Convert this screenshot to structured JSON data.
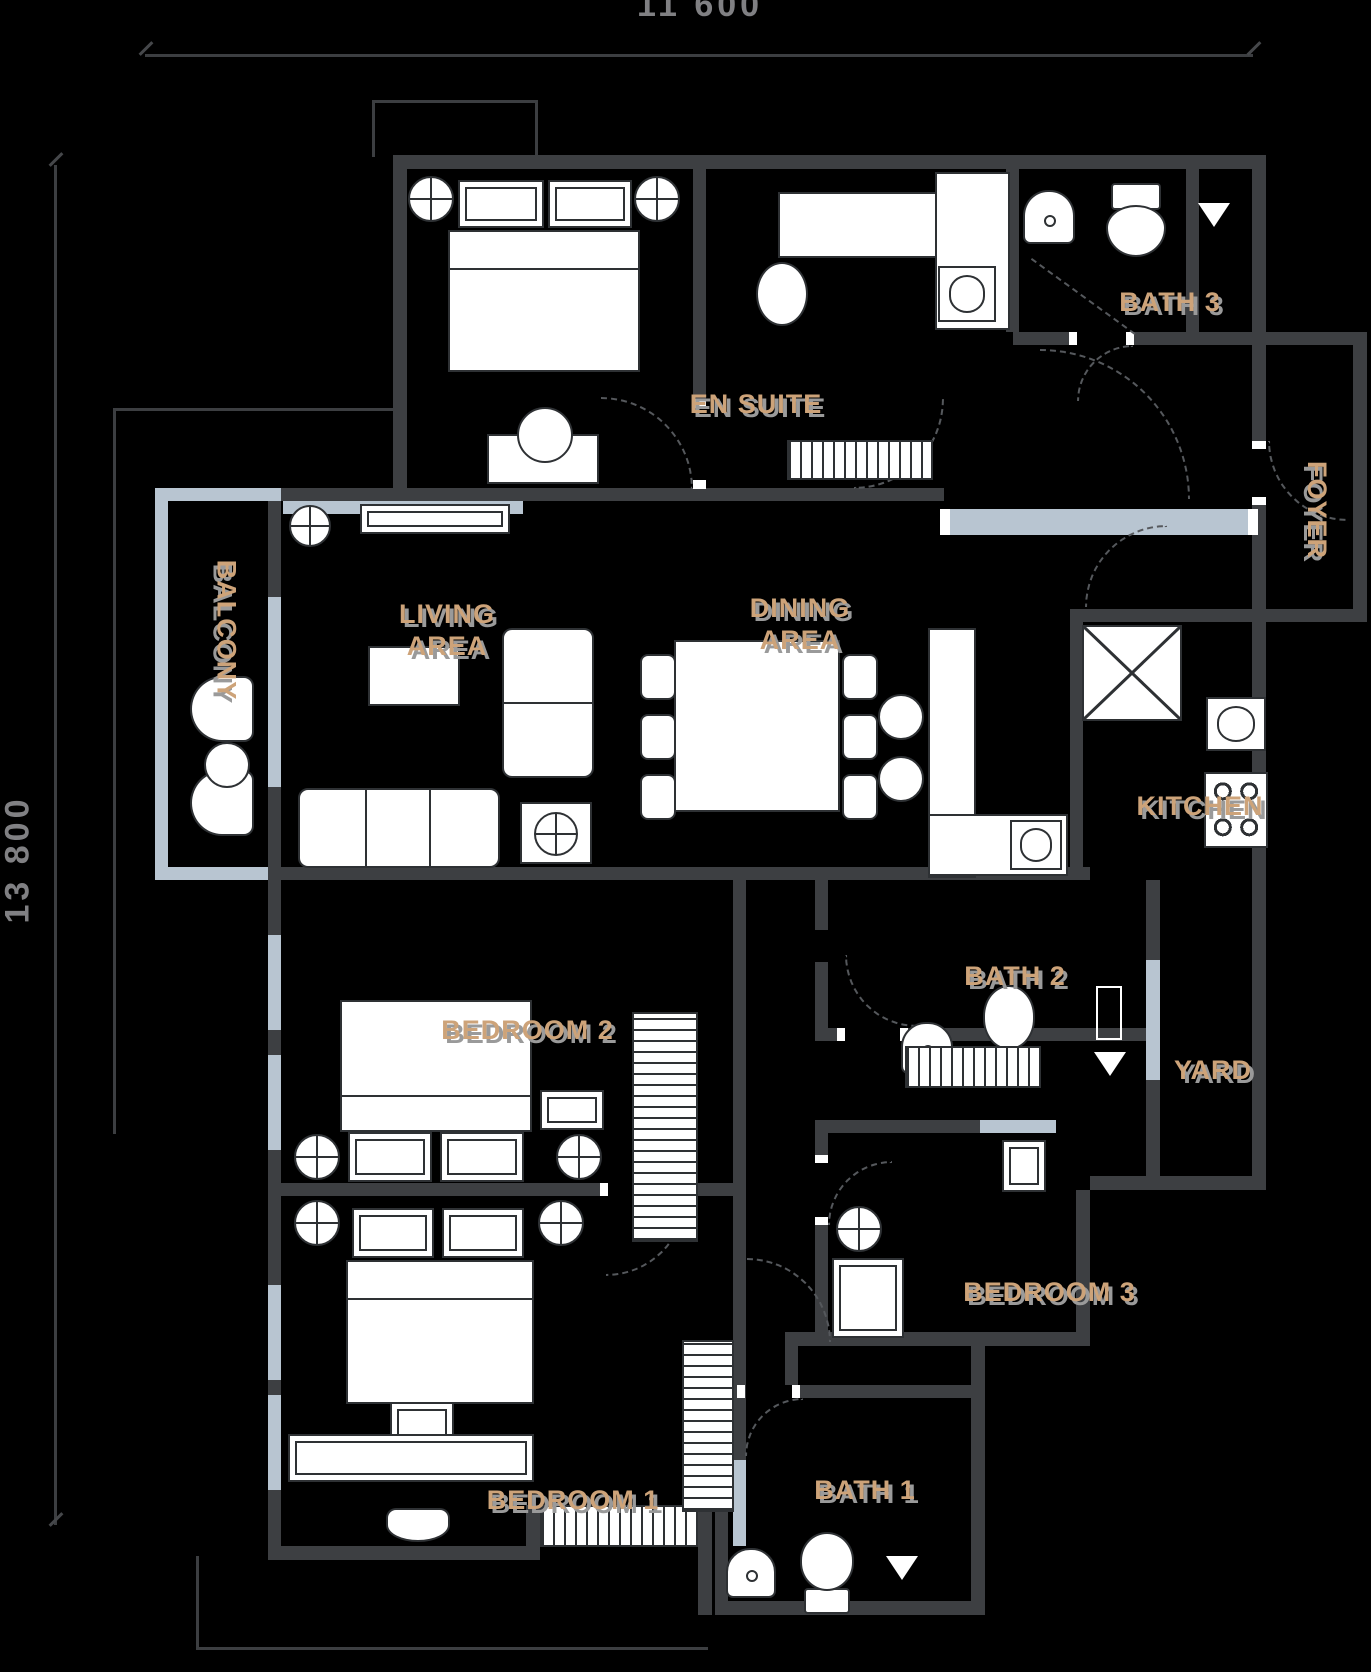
{
  "plan": {
    "dimensions": {
      "width_label": "11 600",
      "height_label": "13 800"
    },
    "rooms": {
      "en_suite": "EN SUITE",
      "bath_3": "BATH 3",
      "foyer": "FOYER",
      "balcony": "BALCONY",
      "living_line1": "LIVING",
      "living_line2": "AREA",
      "dining_line1": "DINING",
      "dining_line2": "AREA",
      "kitchen": "KITCHEN",
      "bath_2": "BATH 2",
      "yard": "YARD",
      "bedroom_2": "BEDROOM 2",
      "bedroom_3": "BEDROOM 3",
      "bedroom_1": "BEDROOM 1",
      "bath_1": "BATH 1"
    },
    "colors": {
      "background": "#000000",
      "wall": "#3d3f42",
      "window_wall": "#b8c5d1",
      "room_label": "#cda379",
      "label_shadow": "#9a9a9a",
      "dimension_text": "#808083",
      "furniture_fill": "#ffffff",
      "furniture_outline": "#2e3134"
    }
  }
}
